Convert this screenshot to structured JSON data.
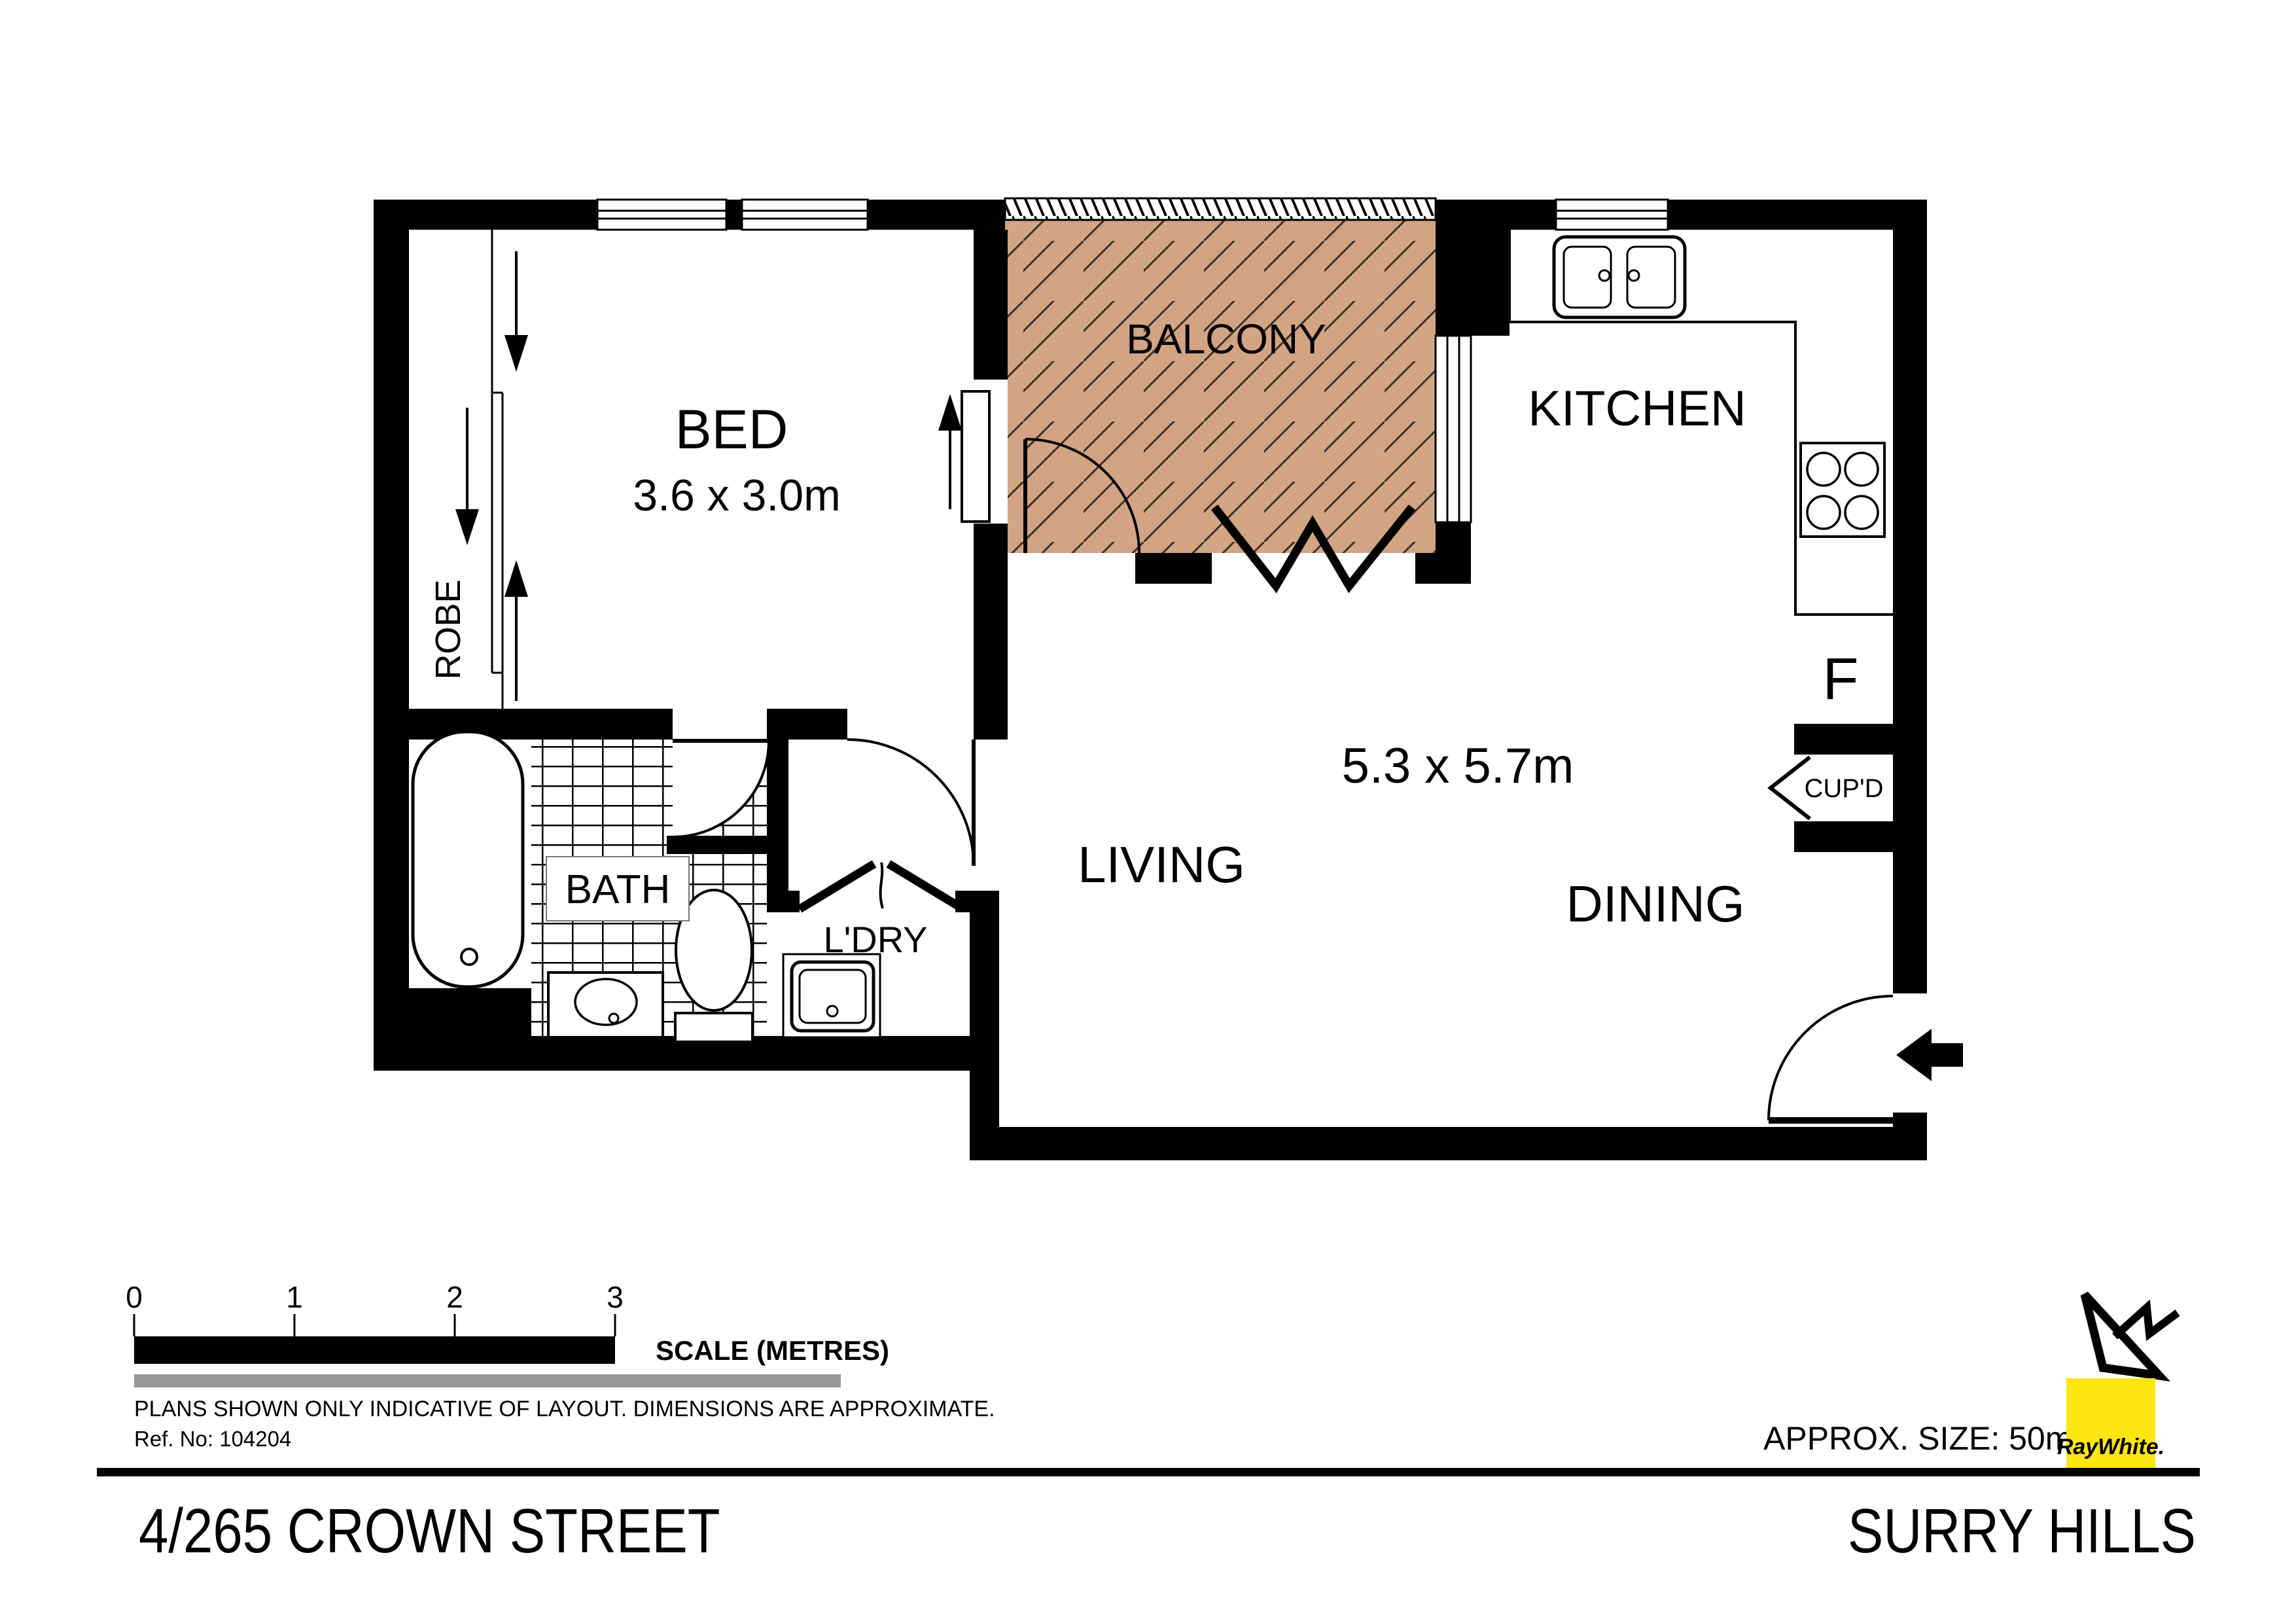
{
  "plan": {
    "rooms": {
      "bed": {
        "label": "BED",
        "dims": "3.6 x 3.0m"
      },
      "balcony": {
        "label": "BALCONY"
      },
      "kitchen": {
        "label": "KITCHEN"
      },
      "living": {
        "label": "LIVING"
      },
      "dining": {
        "label": "DINING"
      },
      "living_dining_dims": "5.3 x 5.7m",
      "bath": {
        "label": "BATH"
      },
      "laundry": {
        "label": "L'DRY"
      },
      "robe": {
        "label": "ROBE"
      },
      "cupboard": {
        "label": "CUP'D"
      },
      "fridge": {
        "label": "F"
      }
    }
  },
  "footer": {
    "scale": {
      "ticks": [
        "0",
        "1",
        "2",
        "3"
      ],
      "label": "SCALE (METRES)"
    },
    "disclaimer": "PLANS SHOWN ONLY INDICATIVE OF LAYOUT.  DIMENSIONS ARE APPROXIMATE.",
    "ref": "Ref. No: 104204",
    "approx_size": "APPROX. SIZE: 50m²",
    "brand": {
      "name": "RayWhite."
    },
    "address": "4/265 CROWN STREET",
    "suburb": "SURRY HILLS"
  },
  "colors": {
    "wall": "#000000",
    "balcony_fill": "#d2a483",
    "scale_gray": "#9a9a9a",
    "brand_yellow": "#ffe512",
    "brand_text": "#58595b"
  }
}
